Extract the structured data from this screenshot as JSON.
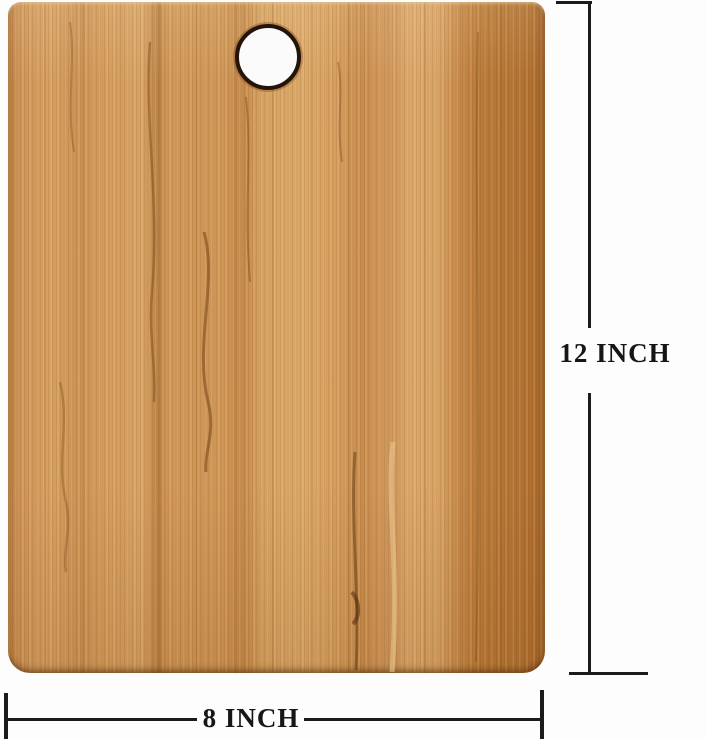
{
  "image": {
    "description": "Product photo of a rectangular bamboo wood cutting board with a round hanging hole near the top center, annotated with its dimensions",
    "background_color": "#fdfdfd"
  },
  "board": {
    "material": "bamboo wood",
    "base_color": "#cf9354",
    "dark_band_color": "#ab6a2c",
    "light_band_color": "#dba766",
    "hole": {
      "shape": "circle",
      "fill_color": "#fbfbfb",
      "ring_color": "#241409"
    }
  },
  "annotations": {
    "line_color": "#1b1b1b",
    "height": {
      "label": "12 INCH",
      "value": 12,
      "unit": "inch",
      "orientation": "vertical"
    },
    "width": {
      "label": "8 INCH",
      "value": 8,
      "unit": "inch",
      "orientation": "horizontal"
    }
  }
}
